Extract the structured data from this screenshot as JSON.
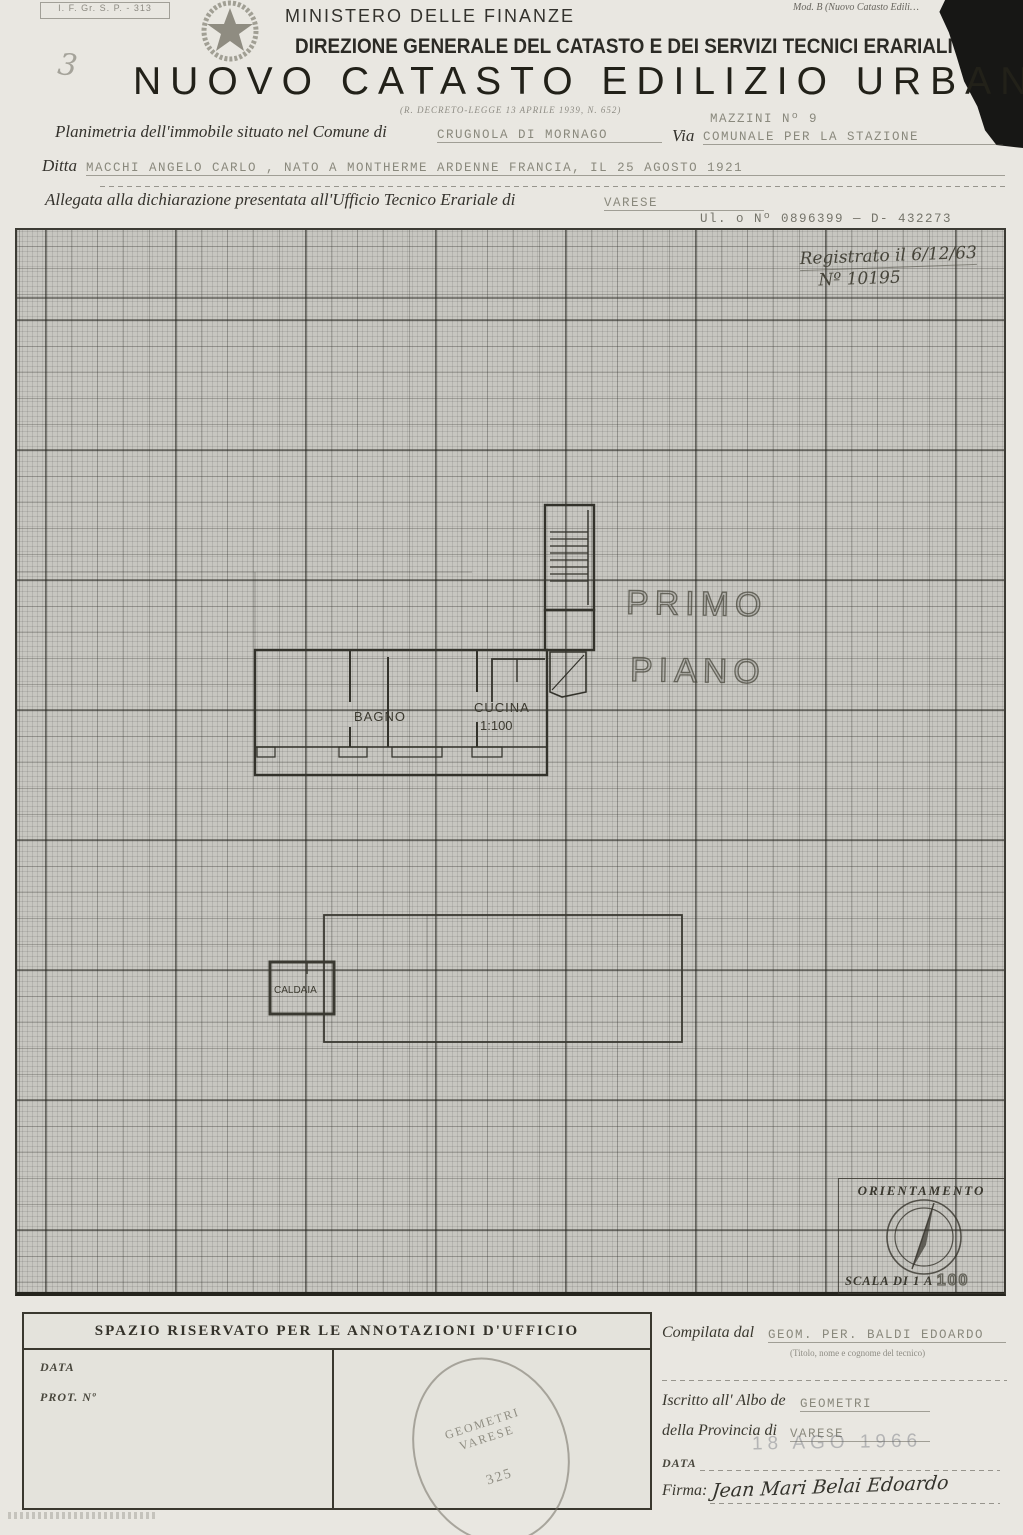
{
  "header": {
    "corner_ref": "I. F. Gr. S. P. - 313",
    "corner_mark": "3",
    "mod_label": "Mod. B (Nuovo Catasto Edili…",
    "ministry": "MINISTERO DELLE FINANZE",
    "direction": "DIREZIONE GENERALE DEL CATASTO E DEI SERVIZI TECNICI ERARIALI",
    "title": "NUOVO CATASTO EDILIZIO URBANO",
    "law_ref": "(R. DECRETO-LEGGE 13 APRILE 1939, N. 652)"
  },
  "form": {
    "planimetria_label": "Planimetria dell'immobile situato nel Comune di",
    "comune_value": "CRUGNOLA DI MORNAGO",
    "via_label": "Via",
    "via_value": "COMUNALE PER LA STAZIONE",
    "via_note": "MAZZINI Nº 9",
    "ditta_label": "Ditta",
    "ditta_value": "MACCHI ANGELO CARLO , NATO A MONTHERME ARDENNE FRANCIA, IL 25 AGOSTO 1921",
    "allegata_label": "Allegata alla dichiarazione presentata all'Ufficio Tecnico Erariale di",
    "ufficio_value": "VARESE",
    "protocol": "Ul. o Nº 0896399 — D- 432273"
  },
  "grid": {
    "registration_line1": "Registrato il 6/12/63",
    "registration_line2": "Nº 10195",
    "floor_line1": "PRIMO",
    "floor_line2": "PIANO",
    "room_bagno": "BAGNO",
    "room_cucina": "CUCINA",
    "room_cucina_scale": "1:100",
    "room_caldaia": "CALDAIA",
    "orientamento_label": "ORIENTAMENTO",
    "scala_label": "SCALA DI 1 A",
    "scala_value": "100"
  },
  "footer": {
    "annotazioni_title": "SPAZIO RISERVATO PER LE ANNOTAZIONI D'UFFICIO",
    "data_label": "DATA",
    "prot_label": "PROT. Nº",
    "stamp_line1": "GEOMETRI",
    "stamp_line2": "VARESE",
    "stamp_number": "325",
    "compilata_label": "Compilata dal",
    "compilata_value": "GEOM. PER. BALDI EDOARDO",
    "compilata_note": "(Titolo, nome e cognome del tecnico)",
    "iscritto_label": "Iscritto all' Albo de",
    "iscritto_value": "GEOMETRI",
    "provincia_label": "della Provincia di",
    "provincia_value": "VARESE",
    "footer_data_label": "DATA",
    "date_stamp": "18 AGO 1966",
    "firma_label": "Firma:",
    "firma_value": "Jean Mari Belai Edoardo"
  }
}
